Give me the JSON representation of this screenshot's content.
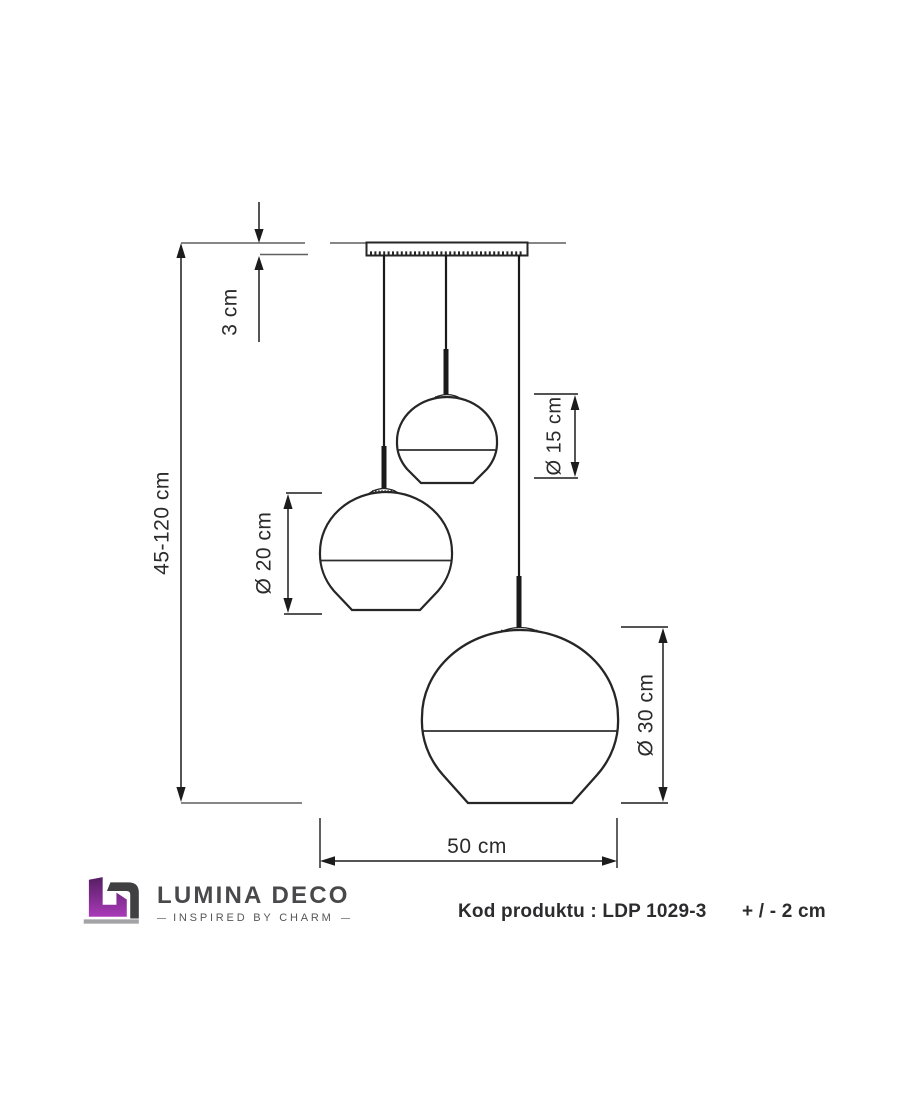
{
  "diagram": {
    "title": "pendant-lamp-dimension-drawing",
    "dimensions": {
      "canopy_height": "3 cm",
      "suspension_height": "45-120 cm",
      "small_shade_diameter": "Ø 15 cm",
      "medium_shade_diameter": "Ø 20 cm",
      "large_shade_diameter": "Ø 30 cm",
      "total_width": "50 cm"
    },
    "shade_count": 3
  },
  "footer": {
    "brand": "LUMINA DECO",
    "tagline": "INSPIRED BY CHARM",
    "product_code_label": "Kod produktu : LDP 1029-3",
    "tolerance": "+ / - 2 cm"
  },
  "icons": {
    "logo": "lumina-deco-monogram-icon"
  },
  "colors": {
    "background": "#ffffff",
    "outline": "#262626",
    "dimension_line": "#1c1c1c",
    "extension_line": "#5f5f5f",
    "text": "#2b2b2b",
    "brand_purple_dark": "#561e63",
    "brand_purple_light": "#a93ab9",
    "brand_gray": "#404043",
    "logo_shadow": "#a3a3a5"
  }
}
